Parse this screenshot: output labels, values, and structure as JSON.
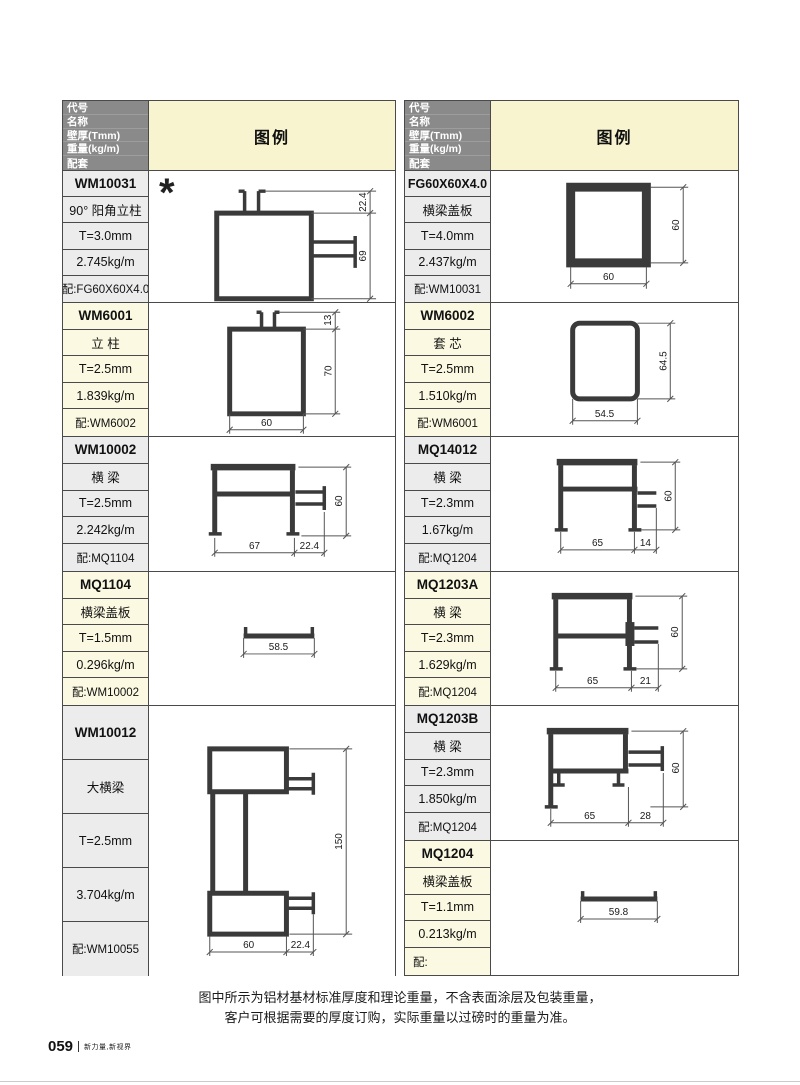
{
  "header": {
    "row_labels": [
      "代号",
      "名称",
      "壁厚(Tmm)",
      "重量(kg/m)",
      "配套"
    ],
    "legend": "图例"
  },
  "left_rows": [
    {
      "code": "WM10031",
      "name": "90° 阳角立柱",
      "thickness": "T=3.0mm",
      "weight": "2.745kg/m",
      "match": "配:FG60X60X4.0",
      "star": "*",
      "dims": {
        "v1": "22.4",
        "v2": "69"
      }
    },
    {
      "code": "WM6001",
      "name": "立 柱",
      "thickness": "T=2.5mm",
      "weight": "1.839kg/m",
      "match": "配:WM6002",
      "dims": {
        "v1": "13",
        "v2": "70",
        "h1": "60"
      }
    },
    {
      "code": "WM10002",
      "name": "横 梁",
      "thickness": "T=2.5mm",
      "weight": "2.242kg/m",
      "match": "配:MQ1104",
      "dims": {
        "v1": "60",
        "h1": "67",
        "h2": "22.4"
      }
    },
    {
      "code": "MQ1104",
      "name": "横梁盖板",
      "thickness": "T=1.5mm",
      "weight": "0.296kg/m",
      "match": "配:WM10002",
      "dims": {
        "h1": "58.5"
      }
    },
    {
      "code": "WM10012",
      "name": "大横梁",
      "thickness": "T=2.5mm",
      "weight": "3.704kg/m",
      "match": "配:WM10055",
      "dims": {
        "v1": "150",
        "h1": "60",
        "h2": "22.4"
      }
    }
  ],
  "right_rows": [
    {
      "code": "FG60X60X4.0",
      "name": "横梁盖板",
      "thickness": "T=4.0mm",
      "weight": "2.437kg/m",
      "match": "配:WM10031",
      "dims": {
        "v1": "60",
        "h1": "60"
      }
    },
    {
      "code": "WM6002",
      "name": "套 芯",
      "thickness": "T=2.5mm",
      "weight": "1.510kg/m",
      "match": "配:WM6001",
      "dims": {
        "v1": "64.5",
        "h1": "54.5"
      }
    },
    {
      "code": "MQ14012",
      "name": "横 梁",
      "thickness": "T=2.3mm",
      "weight": "1.67kg/m",
      "match": "配:MQ1204",
      "dims": {
        "v1": "60",
        "h1": "65",
        "h2": "14"
      }
    },
    {
      "code": "MQ1203A",
      "name": "横 梁",
      "thickness": "T=2.3mm",
      "weight": "1.629kg/m",
      "match": "配:MQ1204",
      "dims": {
        "v1": "60",
        "h1": "65",
        "h2": "21"
      }
    },
    {
      "code": "MQ1203B",
      "name": "横 梁",
      "thickness": "T=2.3mm",
      "weight": "1.850kg/m",
      "match": "配:MQ1204",
      "dims": {
        "v1": "60",
        "h1": "65",
        "h2": "28"
      }
    },
    {
      "code": "MQ1204",
      "name": "横梁盖板",
      "thickness": "T=1.1mm",
      "weight": "0.213kg/m",
      "match": "配:",
      "dims": {
        "h1": "59.8"
      }
    }
  ],
  "footnote": {
    "line1": "图中所示为铝材基材标准厚度和理论重量，不含表面涂层及包装重量，",
    "line2": "客户可根据需要的厚度订购，实际重量以过磅时的重量为准。"
  },
  "footer": {
    "page_number": "059",
    "tagline": "新力量,新视界"
  },
  "colors": {
    "header_bg": "#8a8a8a",
    "legend_bg": "#f8f4cf",
    "row_gray": "#ececec",
    "row_yellow": "#fbf9e2",
    "border": "#4a4a4a",
    "profile_stroke": "#3a3a3a"
  }
}
